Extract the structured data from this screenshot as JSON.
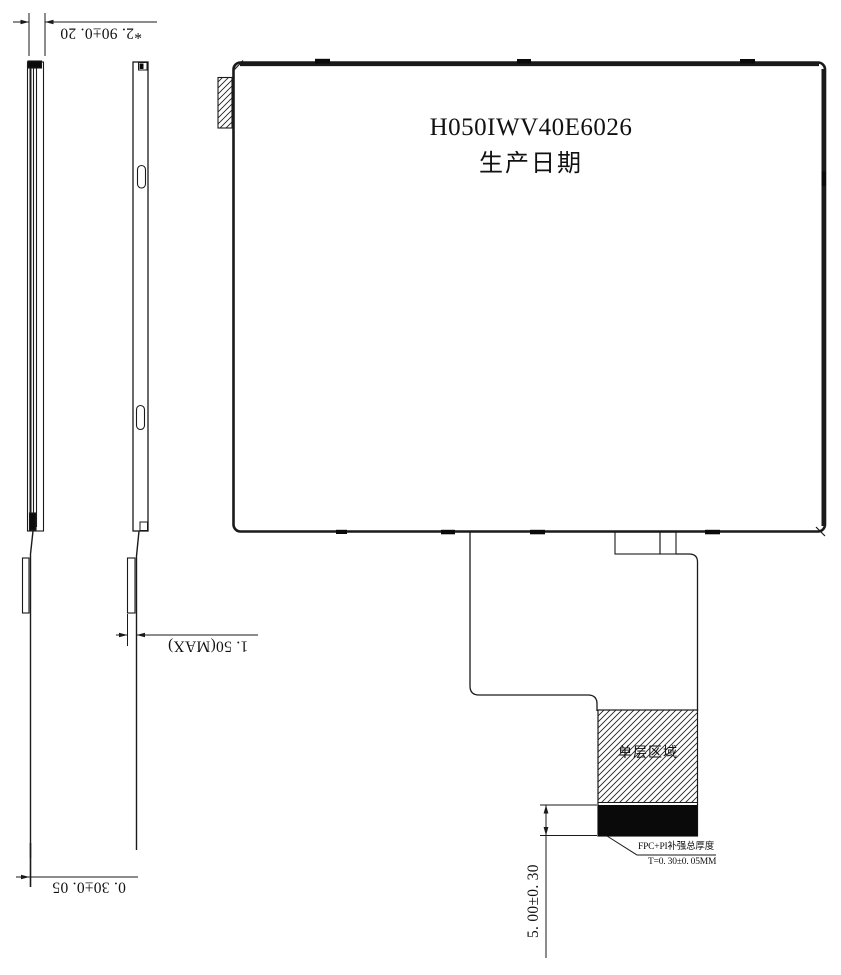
{
  "drawing": {
    "panel": {
      "model": "H050IWV40E6026",
      "production_date_label": "生产日期"
    },
    "fpc": {
      "single_layer_area_label": "单层区域",
      "note_title": "FPC+PI补强总厚度",
      "note_value": "T=0. 30±0. 05MM"
    },
    "dimensions": {
      "overall_thickness": "*2. 90±0. 20",
      "stiffener_thickness_max": "1. 50(MAX)",
      "fpc_thickness": "0. 30±0. 05",
      "tail_length": "5. 00±0. 30"
    },
    "colors": {
      "line": "#1a1a1a",
      "fill_black": "#0a0a0a",
      "background": "#ffffff"
    }
  }
}
